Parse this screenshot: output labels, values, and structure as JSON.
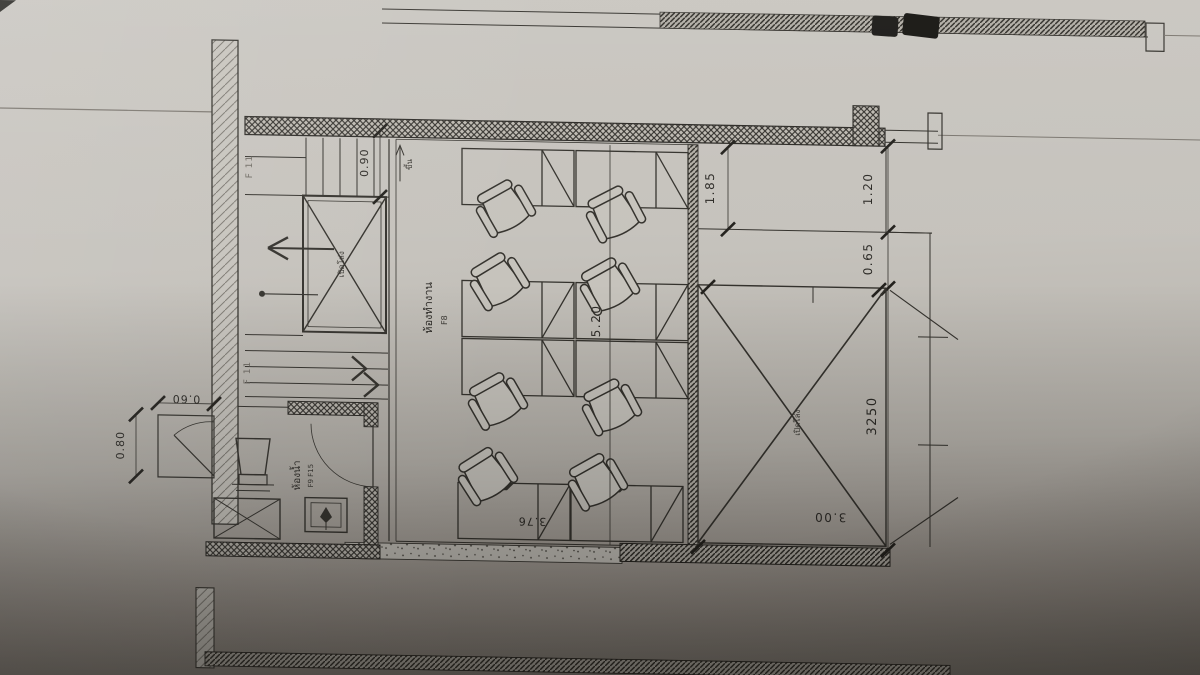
{
  "photo_subject": "architectural-floor-plan-photo",
  "colors": {
    "paper_light": "#c9c6c0",
    "paper_dark": "#7f7a73",
    "ink": "#34322d"
  },
  "plan": {
    "rooms": {
      "office": {
        "name": "ห้องทำงาน",
        "code": "F8"
      },
      "bathroom": {
        "name": "ห้องน้ำ",
        "code": "F9 F15"
      },
      "void": {
        "label": "เปิดโล่ง"
      },
      "stairwell": {
        "label": "เปิดโล่ง",
        "code_upper": "F 11",
        "code_lower": "F 11",
        "up_label": "ขึ้น"
      }
    },
    "dimensions": {
      "stair_width": "0.90",
      "upper_right_depth": "1.85",
      "right_bay_width": "1.20",
      "right_gap": "0.65",
      "office_length": "5.20",
      "office_width": "3.76",
      "void_opening_mm": "3250",
      "void_width": "3.00",
      "store_depth": "0.80",
      "store_width": "0.60"
    }
  }
}
